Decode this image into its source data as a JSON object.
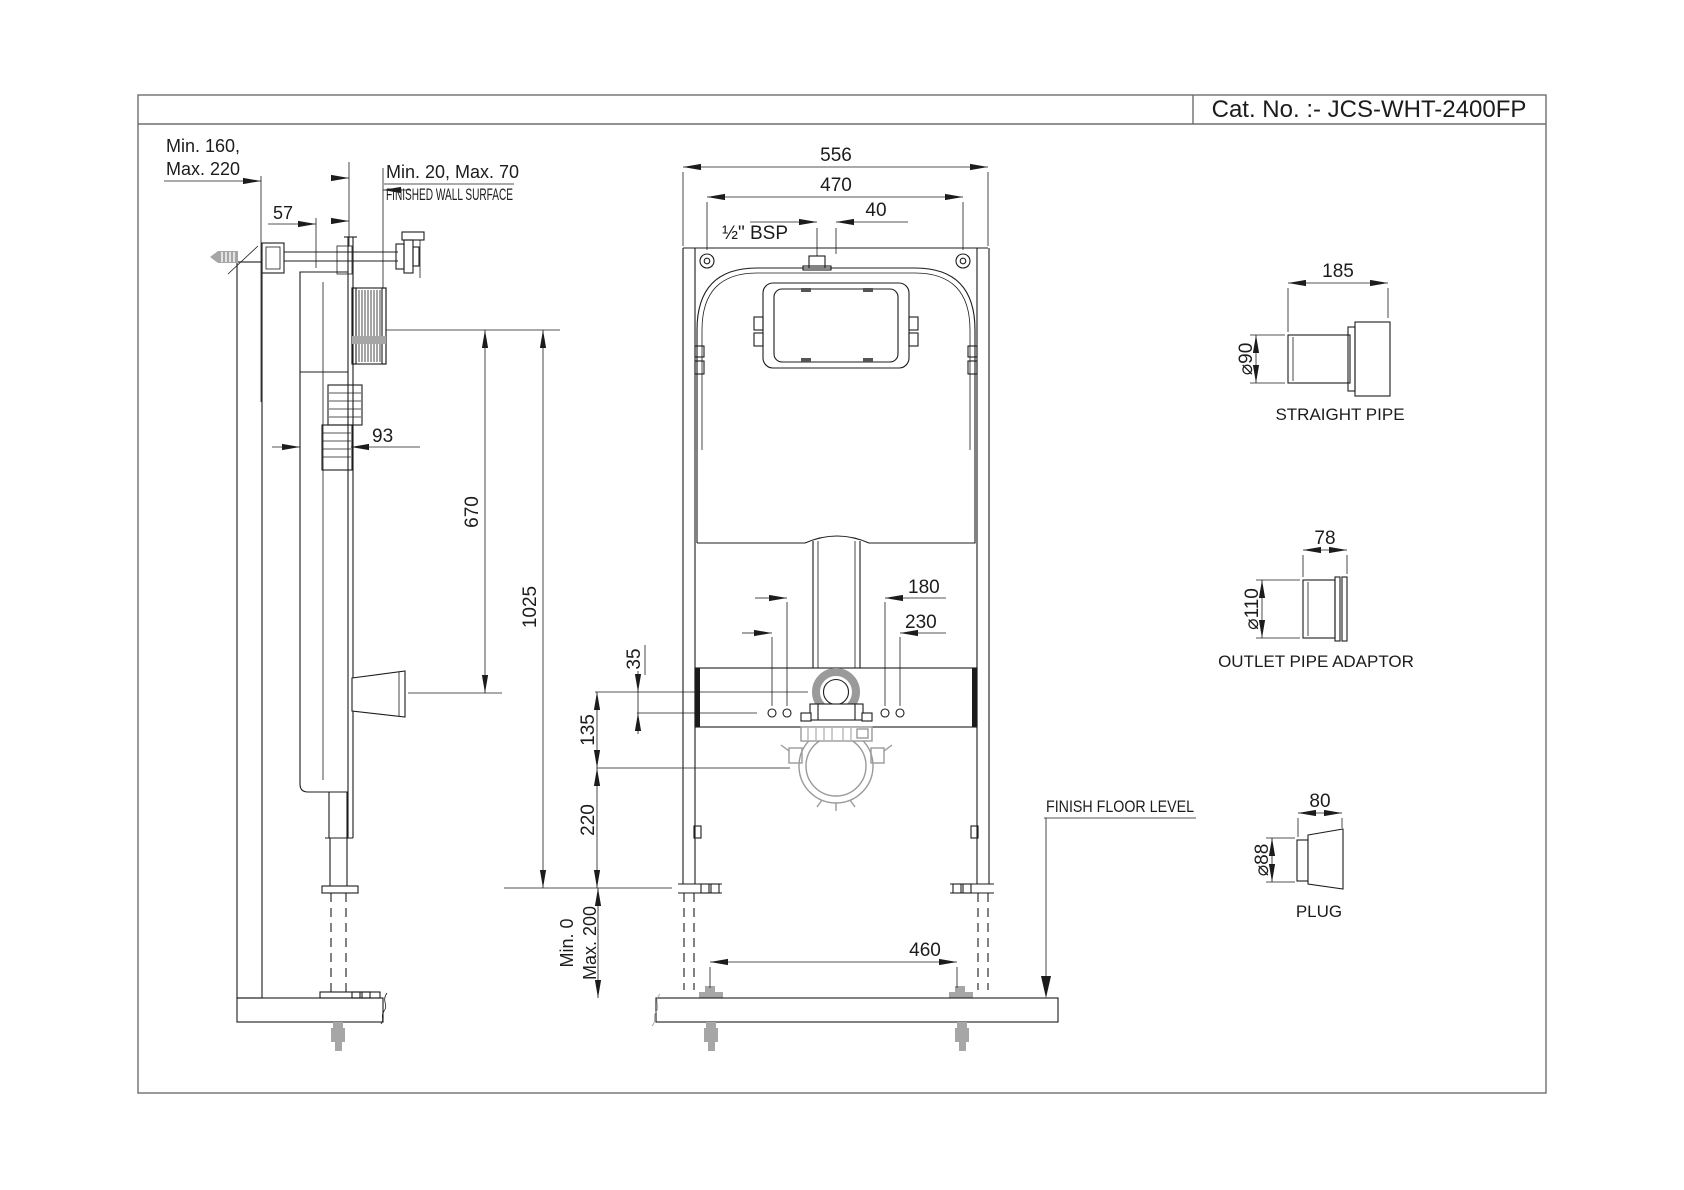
{
  "title": {
    "cat_no": "Cat. No. :- JCS-WHT-2400FP"
  },
  "side_view": {
    "wall_offset_line1": "Min. 160,",
    "wall_offset_line2": "Max. 220",
    "bracket_offset": "57",
    "finish_gap": "Min. 20, Max. 70",
    "finished_wall": "FINISHED WALL SURFACE",
    "depth": "93",
    "inlet_height": "670",
    "frame_height": "1025"
  },
  "front_view": {
    "overall_width": "556",
    "inner_width": "470",
    "inlet_thread": "½\" BSP",
    "inlet_offset": "40",
    "fixing_span_inner": "180",
    "fixing_span_outer": "230",
    "hole_offset": "35",
    "flush_center": "135",
    "outlet_center": "220",
    "leg_min": "Min. 0",
    "leg_max": "Max. 200",
    "anchor_span": "460",
    "floor_label": "FINISH FLOOR LEVEL"
  },
  "parts": {
    "straight_pipe": {
      "label": "STRAIGHT PIPE",
      "length": "185",
      "diameter": "⌀90"
    },
    "outlet_adaptor": {
      "label": "OUTLET PIPE ADAPTOR",
      "length": "78",
      "diameter": "⌀110"
    },
    "plug": {
      "label": "PLUG",
      "length": "80",
      "diameter": "⌀88"
    }
  }
}
